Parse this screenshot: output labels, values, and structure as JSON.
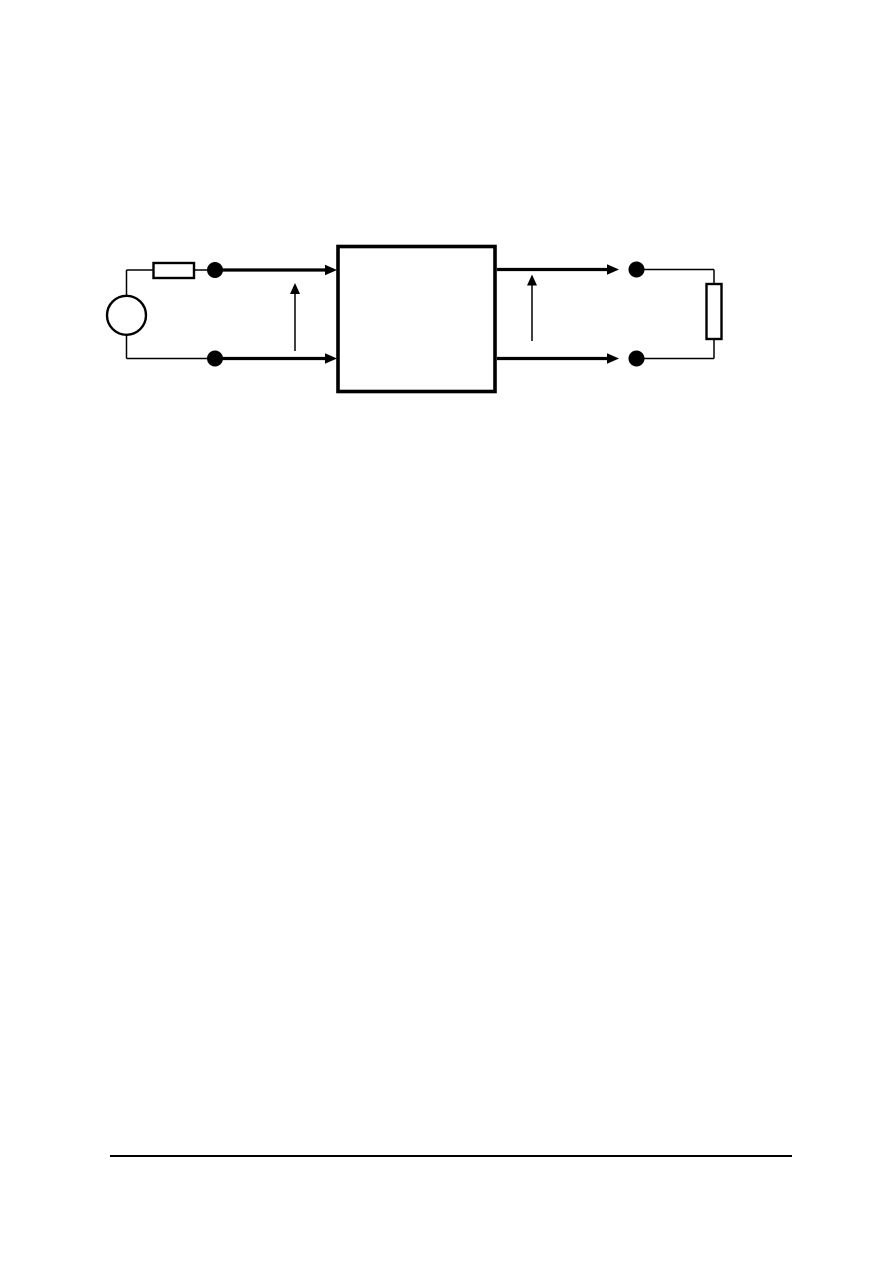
{
  "page": {
    "kind": "document-page-with-figure",
    "visible_text": [],
    "footer": {
      "has_rule": true,
      "text": ""
    }
  },
  "colors": {
    "ink": "#000000",
    "paper": "#ffffff"
  },
  "figure": {
    "name": "two-port-network-circuit-diagram",
    "has_text_labels": false,
    "components": [
      {
        "id": "source-circle",
        "kind": "round source symbol, empty circle, left side"
      },
      {
        "id": "series-resistor",
        "kind": "small horizontal rectangle resistor on upper left conductor"
      },
      {
        "id": "port1-top-terminal",
        "kind": "filled terminal dot"
      },
      {
        "id": "port1-bottom-terminal",
        "kind": "filled terminal dot"
      },
      {
        "id": "port1-current-arrow-top",
        "kind": "thick arrow pointing right into network box"
      },
      {
        "id": "port1-current-arrow-bottom",
        "kind": "thick arrow pointing right into network box"
      },
      {
        "id": "port1-voltage-arrow",
        "kind": "thin vertical arrow pointing up between port-1 conductors"
      },
      {
        "id": "network-box",
        "kind": "large empty rectangle (two-port network)"
      },
      {
        "id": "port2-current-arrow-top",
        "kind": "thick arrow pointing right out of network box"
      },
      {
        "id": "port2-current-arrow-bottom",
        "kind": "thick arrow pointing right out of network box"
      },
      {
        "id": "port2-voltage-arrow",
        "kind": "thin vertical arrow pointing up between port-2 conductors"
      },
      {
        "id": "port2-top-terminal",
        "kind": "filled terminal dot"
      },
      {
        "id": "port2-bottom-terminal",
        "kind": "filled terminal dot"
      },
      {
        "id": "load-resistor",
        "kind": "vertical rectangle load on right side"
      }
    ]
  }
}
